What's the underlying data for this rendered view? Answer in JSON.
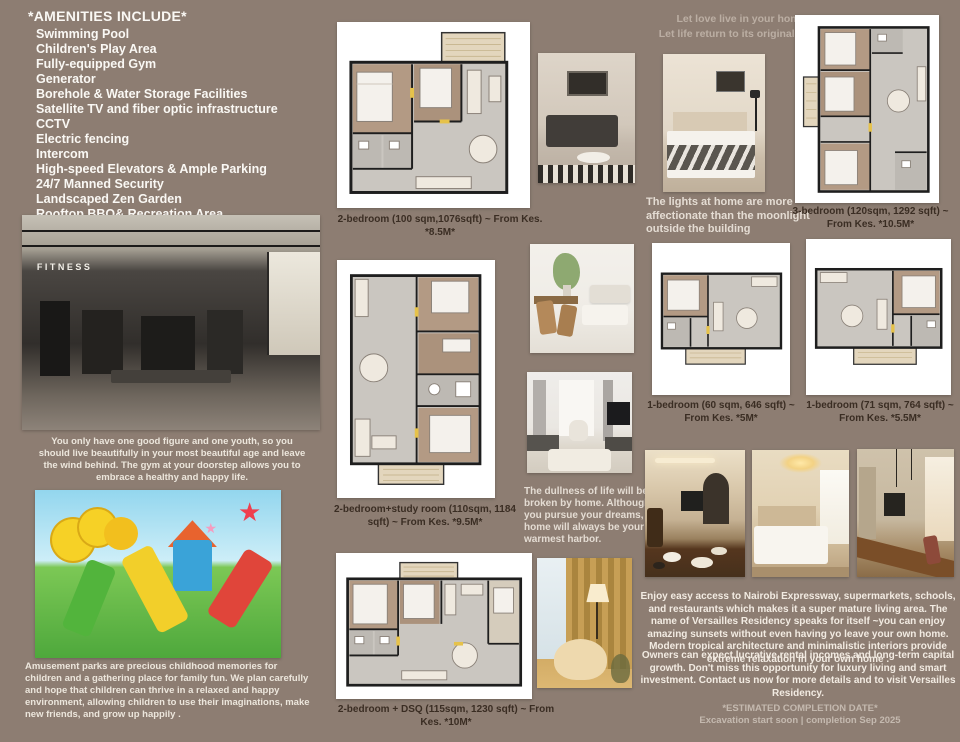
{
  "colors": {
    "background": "#8d7d72",
    "text_light": "#f2ebe2",
    "caption_dark": "#3a2d23",
    "floorplan_wood": "#b39a84",
    "floorplan_tile": "#cac6c0",
    "floorplan_balcony": "#e3d6bd"
  },
  "amenities": {
    "title": "*AMENITIES INCLUDE*",
    "items": [
      "Swimming Pool",
      "Children's Play Area",
      "Fully-equipped Gym",
      "Generator",
      "Borehole & Water Storage Facilities",
      "Satellite TV and fiber optic infrastructure",
      "CCTV",
      "Electric fencing",
      "Intercom",
      "High-speed Elevators & Ample Parking",
      "24/7 Manned Security",
      "Landscaped Zen Garden",
      "Rooftop BBQ& Recreation Area"
    ]
  },
  "gym_section": {
    "sign": "FITNESS",
    "caption": "You only have one good figure and one youth, so you should live beautifully in your most beautiful age and leave the wind behind. The gym at your doorstep allows you to embrace a healthy and happy life."
  },
  "playground_section": {
    "caption": "Amusement parks are precious childhood memories for children and a gathering place for family fun. We plan carefully and hope that children can thrive in a relaxed and happy environment, allowing children to use their imaginations, make new friends, and grow up happily ."
  },
  "floorplans": [
    {
      "caption": "2-bedroom  (100 sqm,1076sqft)  ~  From Kes. *8.5M*"
    },
    {
      "caption": "2-bedroom+study room (110sqm, 1184 sqft)  ~  From Kes. *9.5M*"
    },
    {
      "caption": "2-bedroom + DSQ  (115sqm, 1230 sqft) ~ From Kes. *10M*"
    },
    {
      "caption": "3-bedroom (120sqm, 1292 sqft)  ~ From Kes. *10.5M*"
    },
    {
      "caption": "1-bedroom (60 sqm, 646 sqft)  ~ From Kes.  *5M*"
    },
    {
      "caption": "1-bedroom (71 sqm, 764 sqft) ~ From Kes.  *5.5M*"
    }
  ],
  "quotes": {
    "top_line1": "Let love live in your home",
    "top_line2": "Let life return to its original point",
    "lights": "The lights at home are more affectionate than the moonlight outside the building",
    "dullness": "The dullness of life will be broken by home. Although you pursue your dreams, home will always be your warmest harbor."
  },
  "marketing": {
    "para1": "Enjoy easy access to Nairobi Expressway, supermarkets, schools, and restaurants which makes it a super mature living area. The name of Versailles Residency speaks for itself ~you can enjoy amazing sunsets without even having yo leave your own home. Modern tropical architecture and minimalistic interiors provide extreme relaxation in your own home .",
    "para2": "Owners can expect lucrative rental incomes and long-term capital growth. Don't miss this opportunity for luxury living and smart investment. Contact us now for more details and to visit Versailles Residency.",
    "completion_title": "*ESTIMATED COMPLETION DATE*",
    "completion_detail": "Excavation start soon | completion Sep 2025"
  }
}
